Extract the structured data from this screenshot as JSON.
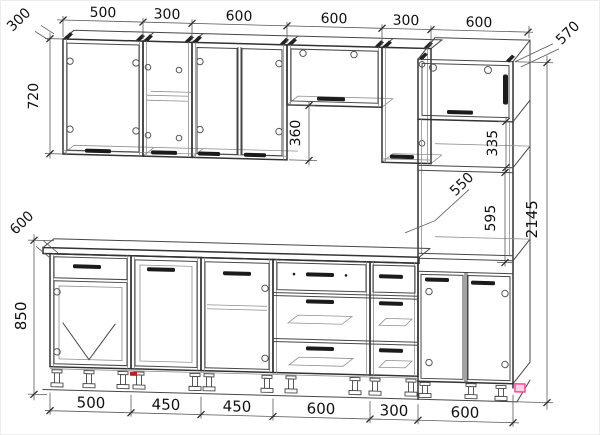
{
  "dimensions": {
    "top_widths": [
      "500",
      "300",
      "600",
      "600",
      "300",
      "600"
    ],
    "bottom_widths": [
      "500",
      "450",
      "450",
      "600",
      "300",
      "600"
    ],
    "upper_depth": "300",
    "upper_height": "720",
    "gap_height": "360",
    "tall_depth": "570",
    "niche_height_335": "335",
    "niche_width_550": "550",
    "niche_height_595": "595",
    "total_height": "2145",
    "base_depth": "600",
    "base_height": "850"
  },
  "colors": {
    "line": "#333333",
    "dim_line": "#5a5a5a",
    "text": "#101010",
    "accent_pink": "#ff3d9a",
    "accent_red": "#bb2222",
    "background": "#ffffff"
  }
}
